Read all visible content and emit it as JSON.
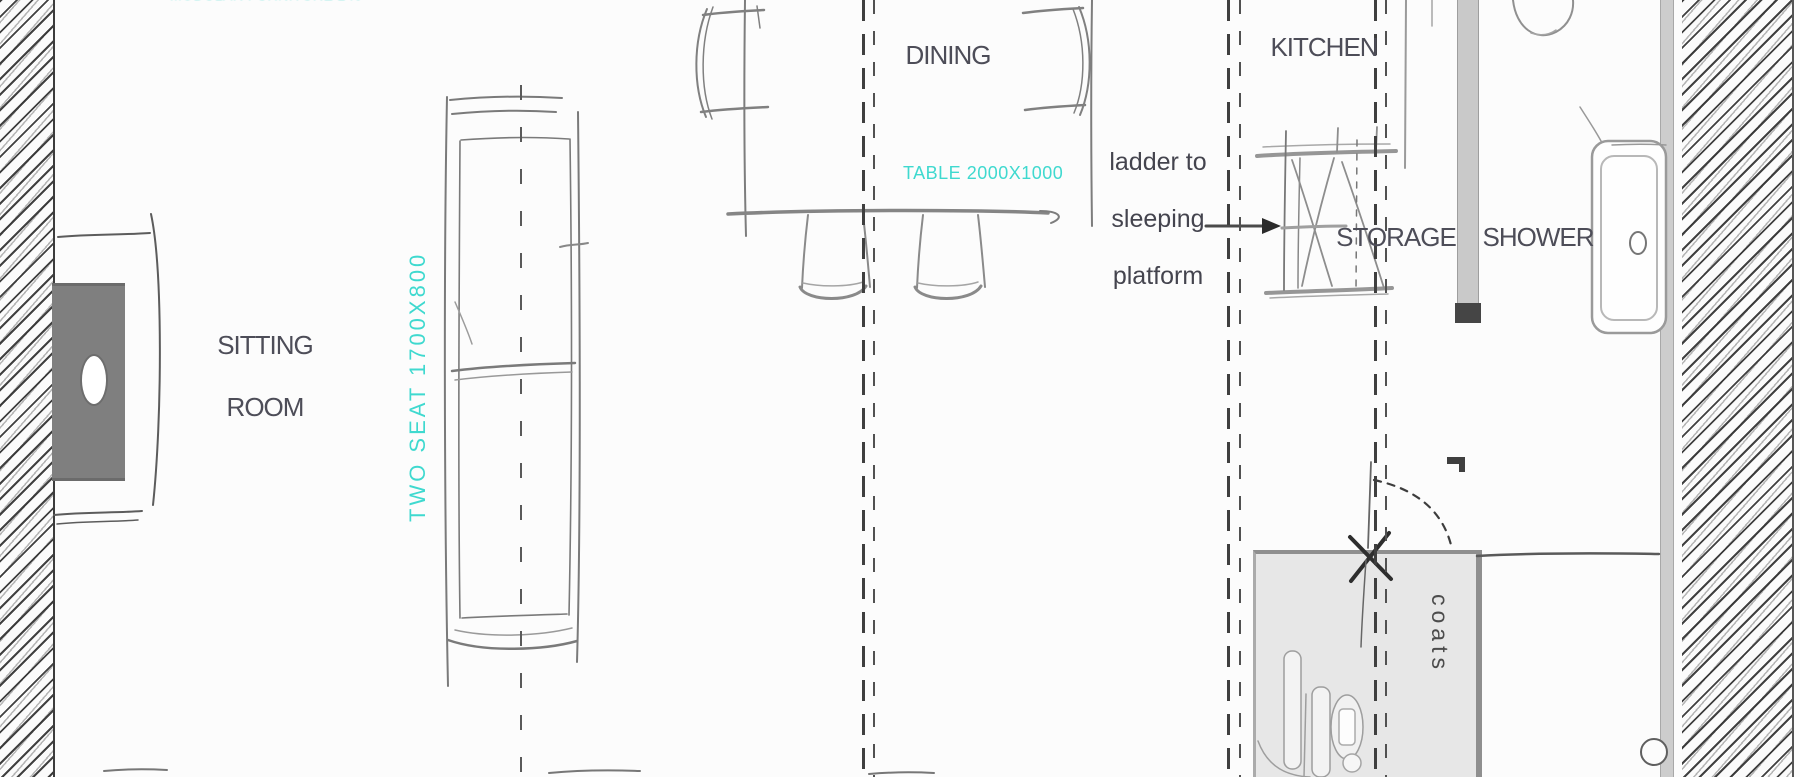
{
  "colors": {
    "cyan_accent": "#3fd9cf",
    "ink": "#4d4d58",
    "stove_fill": "#7f7f7f",
    "closet_fill": "#e7e7e7",
    "divider_bar": "#c9c9c9"
  },
  "rooms": {
    "sitting_room": "SITTING ROOM",
    "dining": "DINING",
    "kitchen": "KITCHEN",
    "storage": "STORAGE",
    "shower": "SHOWER"
  },
  "annotations": {
    "sofa_size": "TWO SEAT 1700X800",
    "table_size": "TABLE 2000X1000",
    "truncated_top": "MODULAR FURNITURE 2400X600",
    "coats": "coats"
  },
  "note": {
    "line1": "ladder to",
    "line2": "sleeping",
    "line3": "platform"
  }
}
